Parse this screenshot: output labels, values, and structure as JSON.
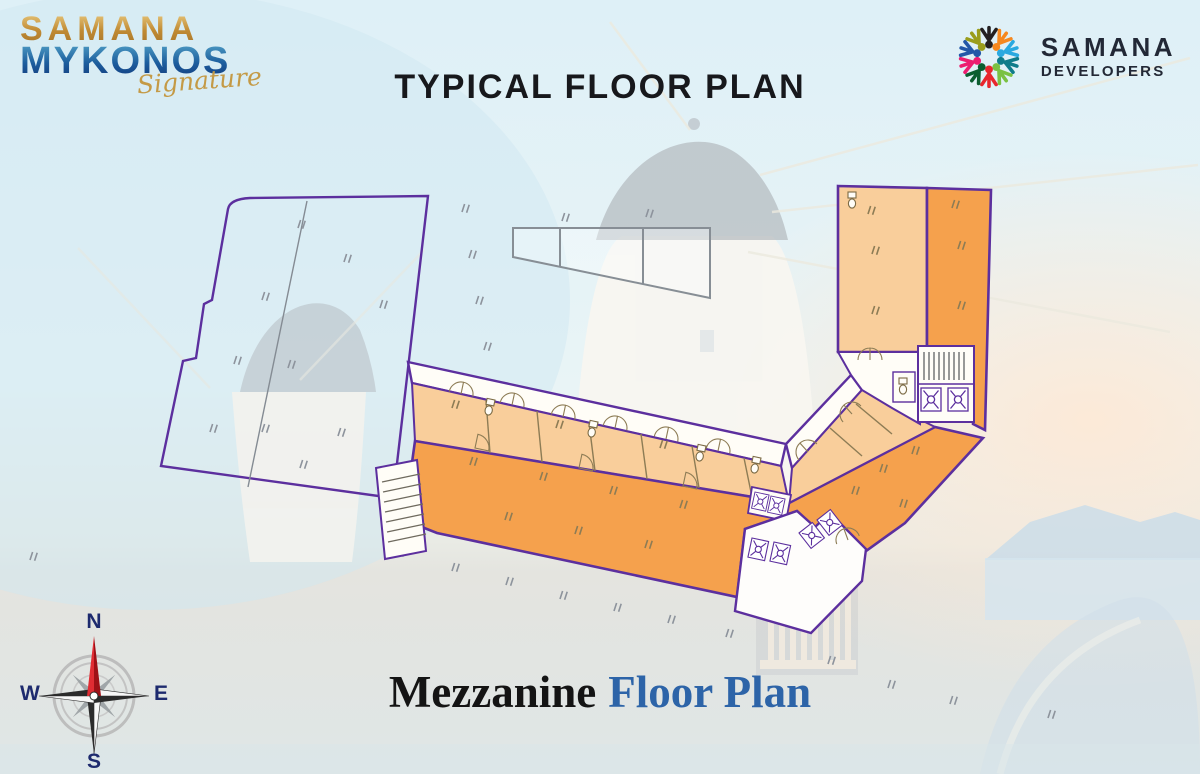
{
  "header": {
    "brand_left": {
      "line1": "SAMANA",
      "line2": "MYKONOS",
      "script": "Signature"
    },
    "title": "TYPICAL FLOOR PLAN",
    "brand_right": {
      "name": "SAMANA",
      "subtitle": "DEVELOPERS"
    }
  },
  "footer": {
    "title_dark": "Mezzanine",
    "title_blue": "Floor Plan"
  },
  "compass": {
    "north": "N",
    "east": "E",
    "south": "S",
    "west": "W"
  },
  "colors": {
    "plan_outline_purple": "#5c2f9e",
    "unit_light": "#f9ce9b",
    "unit_dark": "#f5a14d",
    "corridor_white": "#fffdf7",
    "cad_gray": "#8d939c",
    "detail_olive": "#8d7c55",
    "title_black": "#17181c",
    "footer_blue": "#2d64a8",
    "logo_gold": "#c6973f",
    "logo_blue": "#1d5e9e",
    "compass_navy": "#1d2a6e",
    "compass_red": "#d8232b",
    "developer_text": "#222836"
  },
  "plan": {
    "icons": [
      "compass-rose-icon",
      "stairs-icon",
      "elevator-icon",
      "toilet-icon",
      "door-swing-icon"
    ]
  }
}
